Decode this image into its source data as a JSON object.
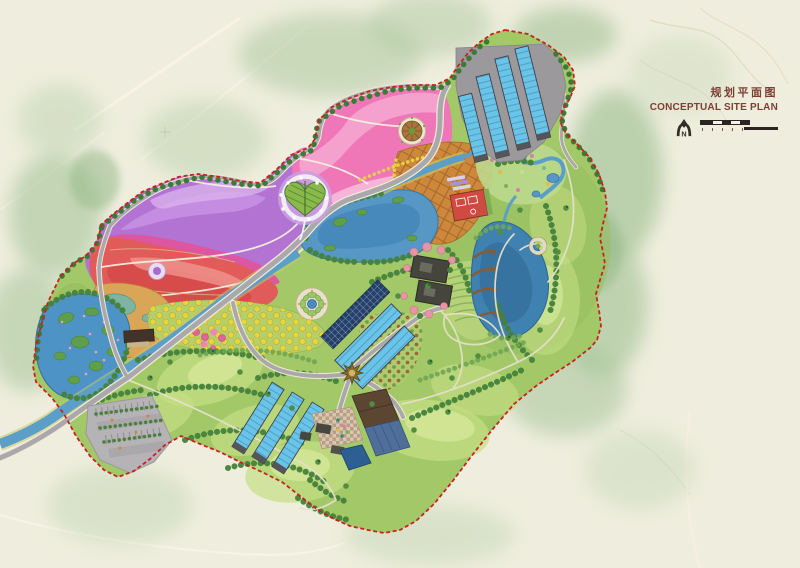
{
  "title_block": {
    "title_zh": "规划平面图",
    "title_en": "CONCEPTUAL SITE PLAN",
    "north_label": "N"
  },
  "map": {
    "colors": {
      "background_cream": "#efeede",
      "surrounding_forest": "#aec9a0",
      "meadow_green": "#a3c868",
      "tree_green": "#45823b",
      "flower_purple": "#b273d3",
      "flower_pink": "#ef76b7",
      "flower_red": "#e25b5b",
      "flower_magenta": "#df549e",
      "water_blue": "#5697c6",
      "greenhouse_blue": "#68c4e9",
      "orchard_orange": "#cd883c",
      "orchard_yellow": "#e6d63e",
      "road_gray": "#aaa8ab",
      "building_charcoal": "#45453d",
      "roof_red": "#cf4b42",
      "boundary_red": "#c92020",
      "title_text": "#7c4033"
    }
  }
}
